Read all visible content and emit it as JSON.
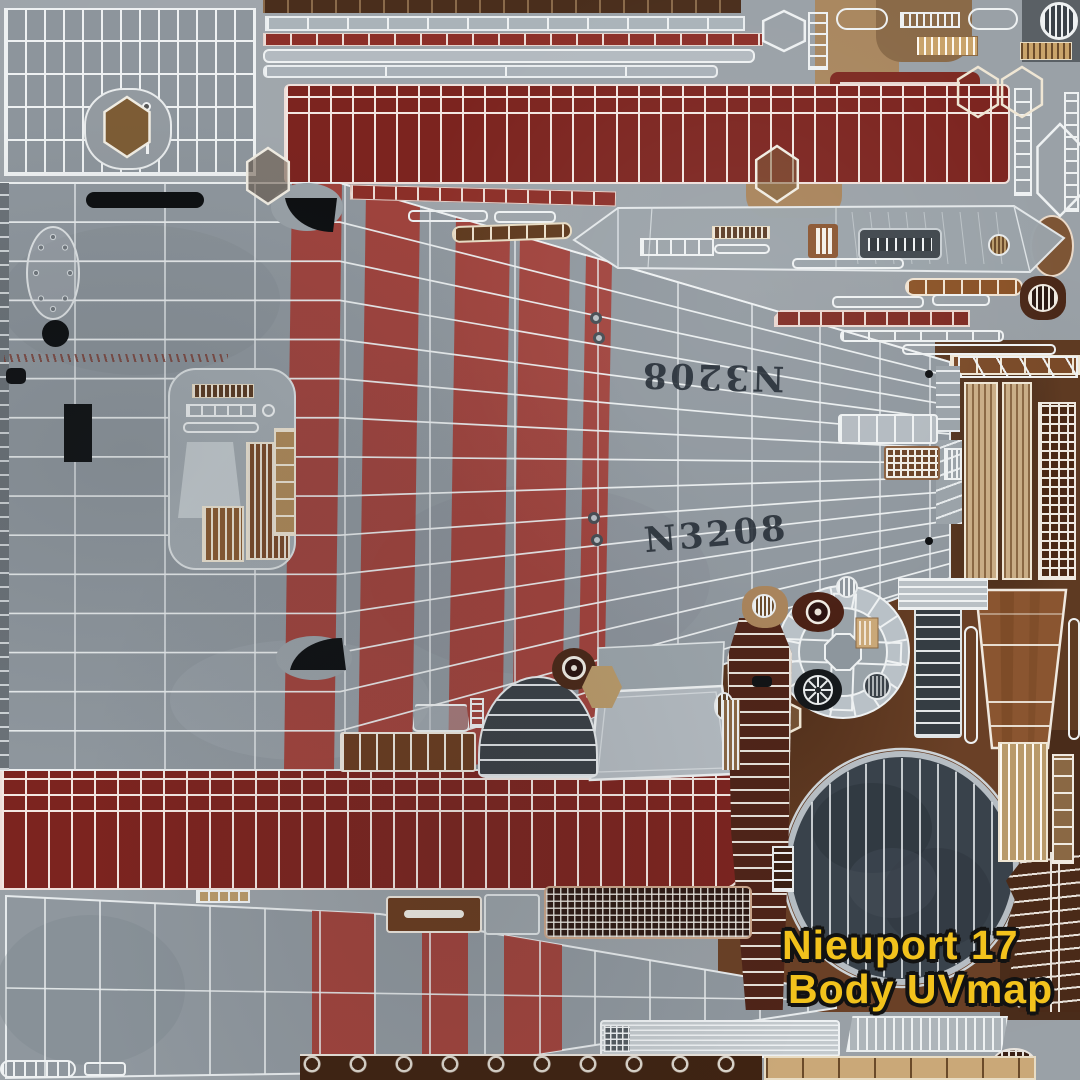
{
  "image": {
    "kind": "uv-texture-atlas",
    "subject": "Nieuport 17 aircraft body texture"
  },
  "labels": {
    "title_line1": "Nieuport 17",
    "title_line2": "Body UVmap",
    "serial_top": "N3208",
    "serial_bottom": "N3208"
  },
  "colors": {
    "canvas_gray": "#9aa1a7",
    "linen_gray": "#8f979e",
    "stripe_red": "#a23a32",
    "band_red": "#7c241f",
    "wireframe_white": "#eef1f2",
    "wood_brown": "#8a5530",
    "dark_wood": "#4a2817",
    "tan": "#b99a6a",
    "panel_slate": "#3a424a",
    "title_yellow": "#f2c21c",
    "serial_ink": "#262e37"
  },
  "parts": [
    "horizontal-stabilizer-grid-panel",
    "leading-edge-strips",
    "upper-wing-red-band",
    "fuselage-side-panel",
    "cockpit-fittings-island",
    "turtledeck-panel",
    "instrument-and-trim-strips",
    "plywood-plank-panels",
    "engine-side-wood-panel",
    "cowling-ring",
    "cowling-front-disc",
    "engine-bearer-ladder",
    "windscreen-and-headrest-panels",
    "lower-wing-red-band",
    "fuselage-bottom-wedge",
    "radiator-mesh",
    "rudder-rib-panel",
    "misc-fastener-strips"
  ]
}
